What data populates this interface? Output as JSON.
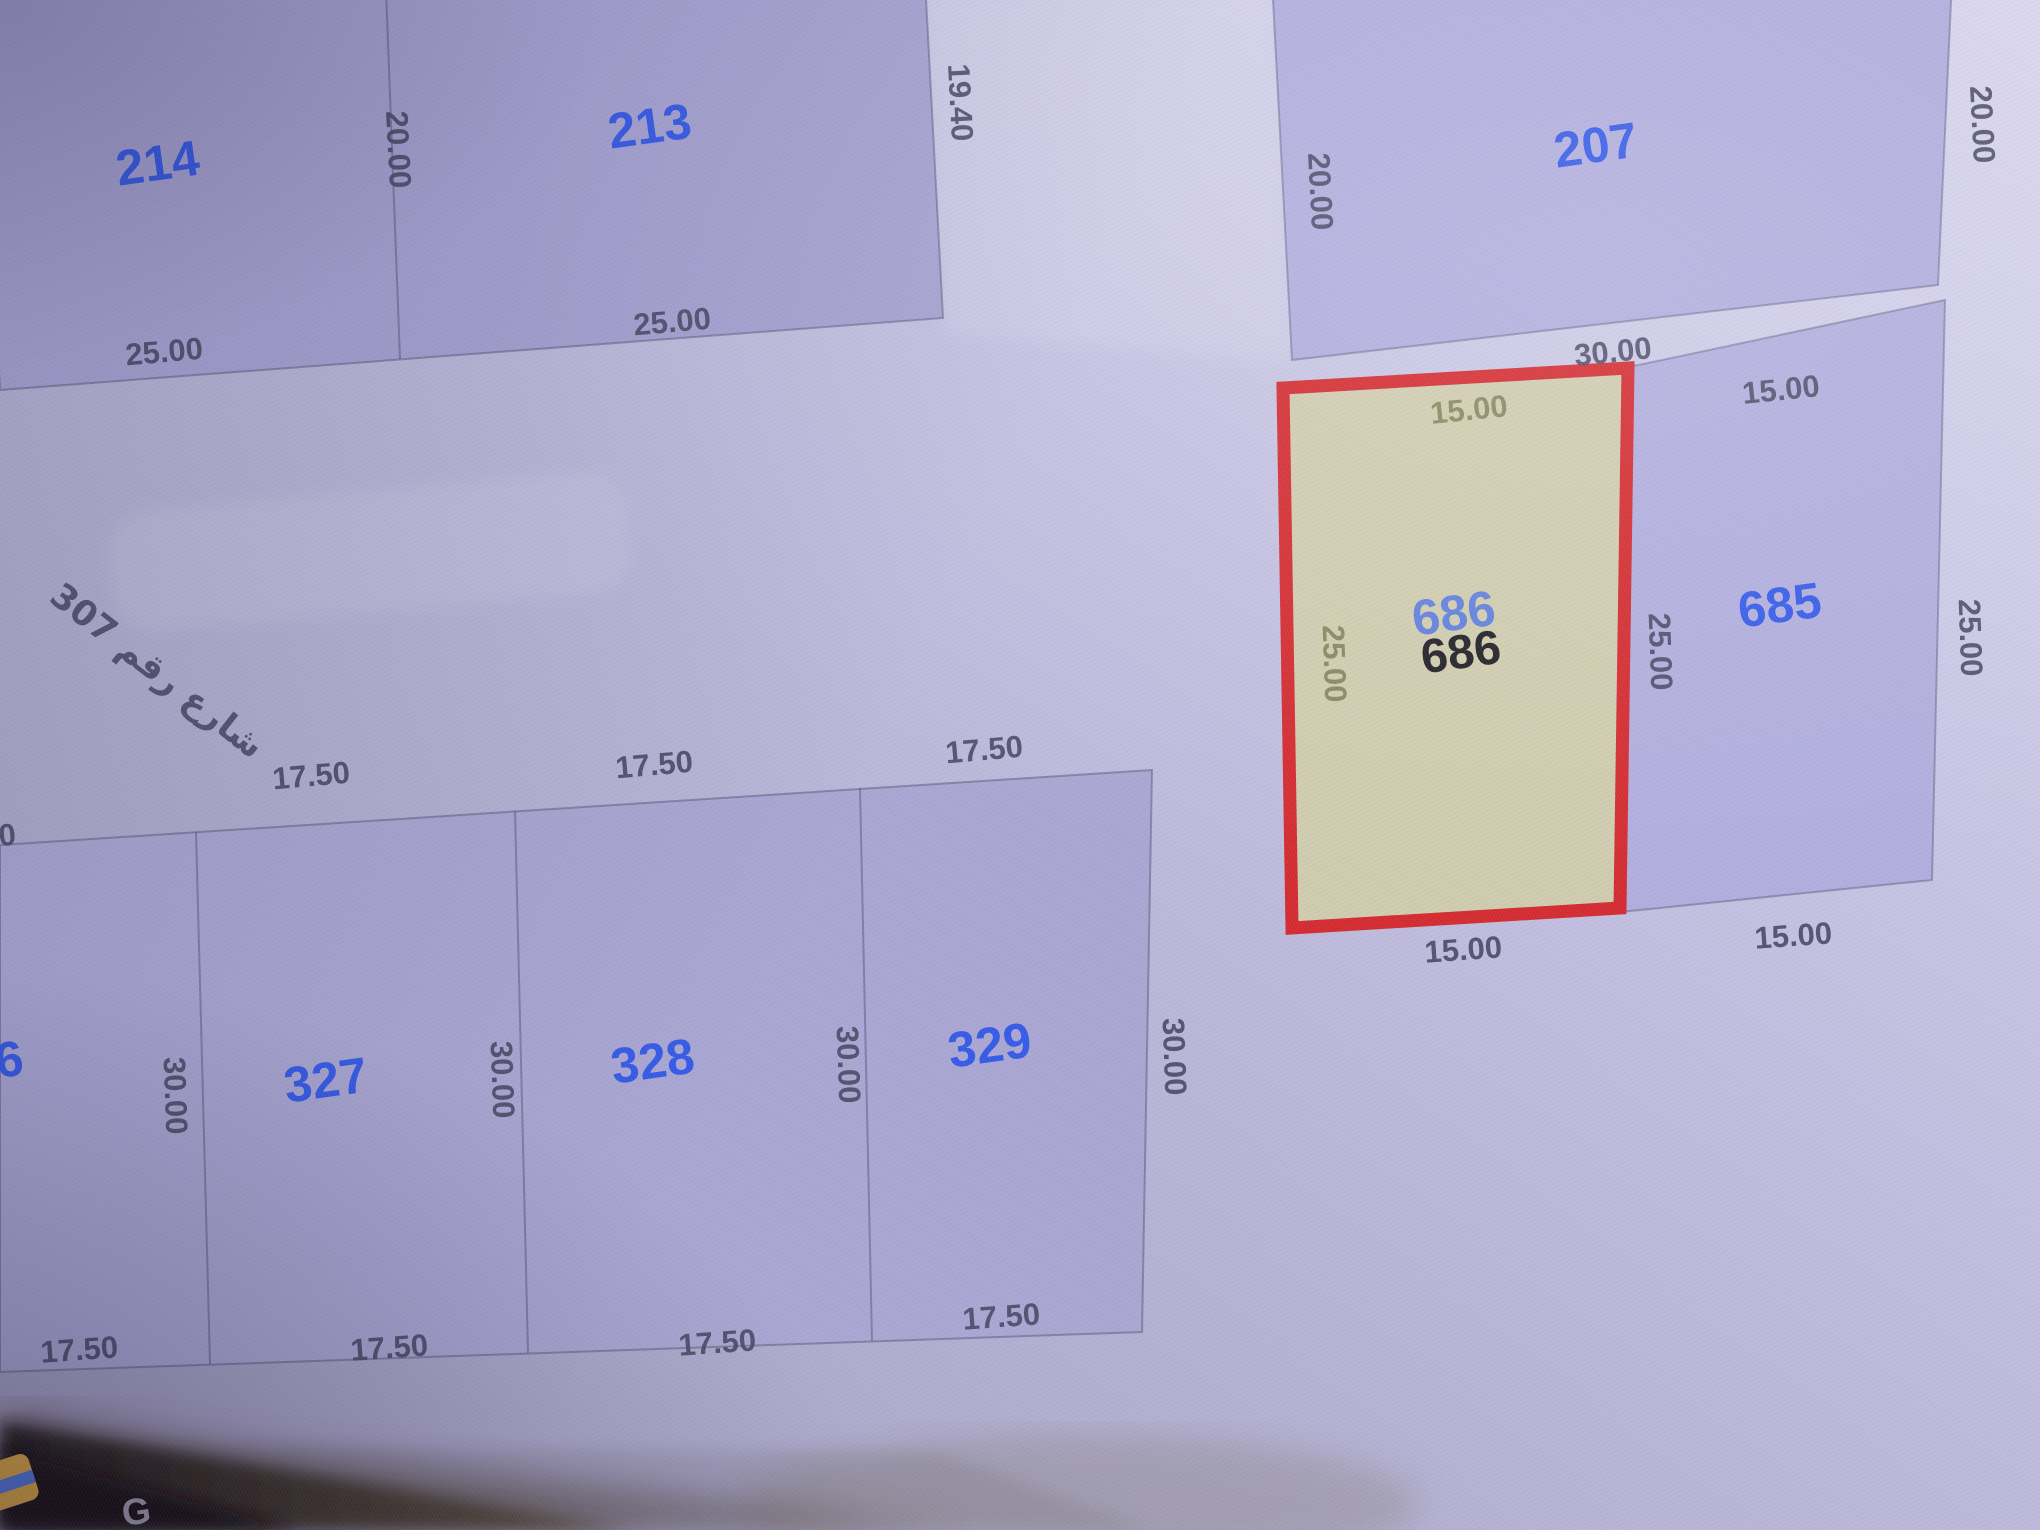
{
  "map": {
    "blocks": {
      "northwest": {
        "parcels": [
          {
            "label": "214"
          },
          {
            "label": "213"
          }
        ],
        "dims": {
          "divider": "20.00",
          "right": "19.40",
          "bottom_left": "25.00",
          "bottom_right": "25.00"
        }
      },
      "northeast": {
        "parcel": {
          "label": "207"
        },
        "dims": {
          "left": "20.00",
          "right": "20.00"
        }
      },
      "east": {
        "selected": {
          "label": "686",
          "ghost_label": "686"
        },
        "parcel_685": {
          "label": "685"
        },
        "dims": {
          "top": "30.00",
          "top_685": "15.00",
          "top_686": "15.00",
          "left_686": "25.00",
          "mid": "25.00",
          "right_685": "25.00",
          "bottom_686": "15.00",
          "bottom_685": "15.00"
        }
      },
      "south": {
        "parcels": [
          "326",
          "327",
          "328",
          "329"
        ],
        "top_dims": [
          "17.50",
          "17.50",
          "17.50",
          "17.50"
        ],
        "side_dims": [
          "30.00",
          "30.00",
          "30.00",
          "30.00"
        ],
        "bottom_dims": [
          "17.50",
          "17.50",
          "17.50",
          "17.50"
        ]
      }
    },
    "street": {
      "label": "شارع رقم 307"
    },
    "colors": {
      "selected_fill": "#cfcbae",
      "selected_border": "#d3292e",
      "parcel_label": "#2b54e8",
      "dim_label": "#4b4a66",
      "olive_label": "#85835c"
    }
  },
  "desktop": {
    "icon_g": "G"
  }
}
